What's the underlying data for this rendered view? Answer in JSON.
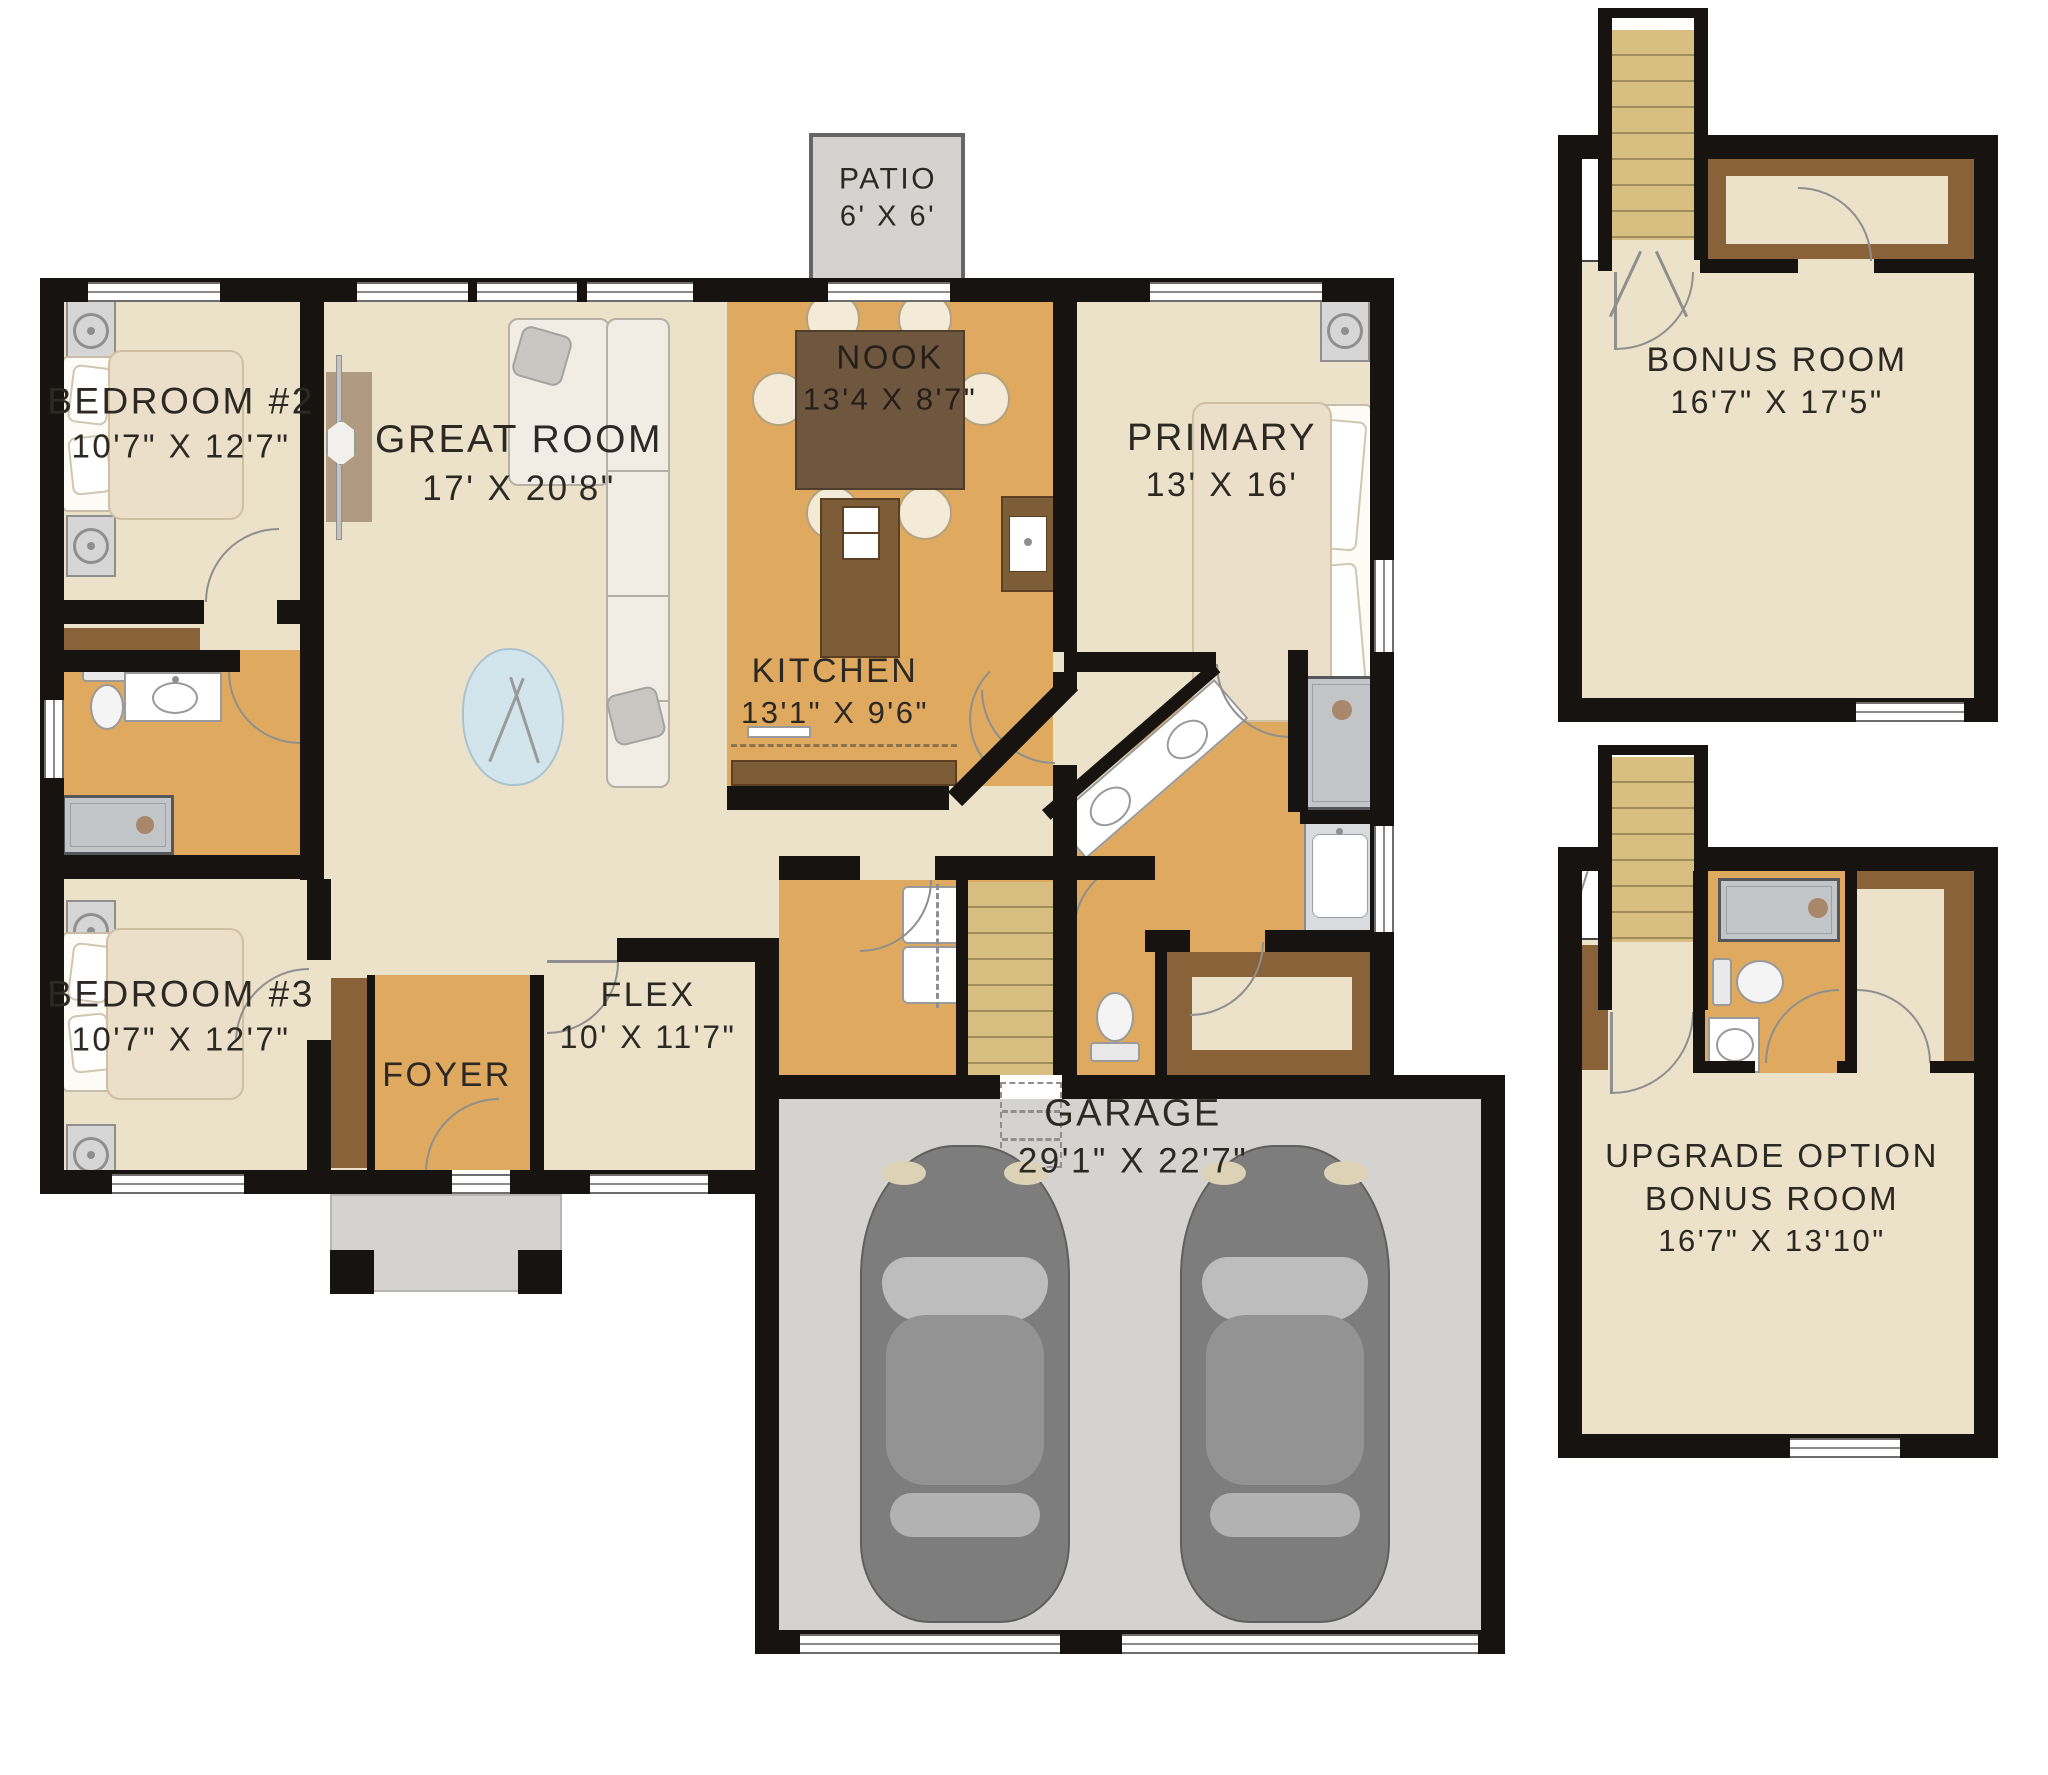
{
  "rooms": {
    "patio": {
      "name": "PATIO",
      "dims": "6' X 6'"
    },
    "nook": {
      "name": "NOOK",
      "dims": "13'4 X 8'7\""
    },
    "great_room": {
      "name": "GREAT ROOM",
      "dims": "17' X 20'8\""
    },
    "bedroom2": {
      "name": "BEDROOM #2",
      "dims": "10'7\" X 12'7\""
    },
    "primary": {
      "name": "PRIMARY",
      "dims": "13' X 16'"
    },
    "kitchen": {
      "name": "KITCHEN",
      "dims": "13'1\" X 9'6\""
    },
    "bedroom3": {
      "name": "BEDROOM #3",
      "dims": "10'7\" X 12'7\""
    },
    "foyer": {
      "name": "FOYER"
    },
    "flex": {
      "name": "FLEX",
      "dims": "10' X 11'7\""
    },
    "garage": {
      "name": "GARAGE",
      "dims": "29'1\" X 22'7\""
    },
    "bonus_room": {
      "name": "BONUS ROOM",
      "dims": "16'7\" X 17'5\""
    },
    "upgrade_bonus": {
      "line1": "UPGRADE OPTION",
      "line2": "BONUS ROOM",
      "dims": "16'7\" X 13'10\""
    }
  },
  "colors": {
    "floor_cream": "#ece2c9",
    "floor_tan": "#dfaa5f",
    "cabinet_brown": "#8a6239",
    "table_brown": "#6e573e",
    "stair_tan": "#d9be81",
    "concrete_gray": "#d4d3d0",
    "wall_black": "#171310",
    "text_dark": "#2c2824"
  }
}
